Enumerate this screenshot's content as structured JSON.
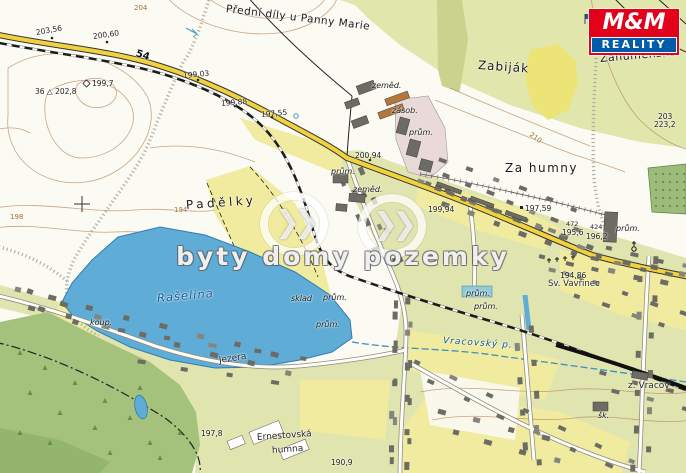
{
  "map_title": "Topographic cadastral map – Vracov area",
  "watermark": {
    "text": "byty domy pozemky",
    "chevrons": "❯❯"
  },
  "logo": {
    "top": "M&M",
    "bottom": "REALITY",
    "red": "#e2001a",
    "blue": "#005ca9"
  },
  "road_badge": {
    "t": "54",
    "x": 136,
    "y": 48,
    "r": 18
  },
  "colors": {
    "lake": "#5facd7",
    "road": "#f1d23e",
    "forest": "#a5c27c",
    "village_green": "#e0e5af",
    "field_yellow": "#f1eba0",
    "contour_brown": "#b5895e",
    "building_gray": "#6c6c64",
    "railway_black": "#1b1b1b",
    "industrial_pink": "#e9d9d8",
    "water_label_blue": "#14568f"
  },
  "labels": {
    "places": [
      {
        "t": "Přední díly u Panny Marie",
        "x": 226,
        "y": 3,
        "r": 7,
        "s": 10.5,
        "ls": 0.5
      },
      {
        "t": "Zabiják",
        "x": 478,
        "y": 58,
        "r": 4,
        "s": 12,
        "ls": 1
      },
      {
        "t": "Záhumenské",
        "x": 600,
        "y": 52,
        "r": -5,
        "s": 11,
        "ls": 0.5
      },
      {
        "t": "Za humny",
        "x": 505,
        "y": 161,
        "r": 0,
        "s": 12,
        "ls": 1.5
      },
      {
        "t": "Padělky",
        "x": 186,
        "y": 198,
        "r": -4,
        "s": 12,
        "ls": 3.5
      }
    ],
    "places_small": [
      {
        "t": "Ernestovská",
        "x": 257,
        "y": 433,
        "r": -4
      },
      {
        "t": "humna",
        "x": 272,
        "y": 446,
        "r": -4
      },
      {
        "t": "Jezera",
        "x": 219,
        "y": 356,
        "r": -9
      },
      {
        "t": "z. Vracov",
        "x": 628,
        "y": 381,
        "r": 0
      },
      {
        "t": "Sv. Vavřinec",
        "x": 548,
        "y": 279,
        "r": 0,
        "s": 8.5
      }
    ],
    "water": [
      {
        "t": "Rašelina",
        "x": 157,
        "y": 291,
        "r": -5,
        "s": 11.5
      },
      {
        "t": "Vracovský p.",
        "x": 443,
        "y": 336,
        "r": 4,
        "s": 9
      }
    ],
    "elevations": [
      {
        "t": "203,56",
        "x": 36,
        "y": 28,
        "r": -10
      },
      {
        "t": "200,60",
        "x": 93,
        "y": 32,
        "r": -8
      },
      {
        "t": "199,7",
        "x": 92,
        "y": 79
      },
      {
        "t": "36 △ 202,8",
        "x": 35,
        "y": 87
      },
      {
        "t": "199,03",
        "x": 183,
        "y": 71,
        "r": -5
      },
      {
        "t": "199,88",
        "x": 221,
        "y": 99,
        "r": -5
      },
      {
        "t": "197,55",
        "x": 261,
        "y": 110,
        "r": -5
      },
      {
        "t": "200,94",
        "x": 355,
        "y": 151
      },
      {
        "t": "199,94",
        "x": 428,
        "y": 205
      },
      {
        "t": "197,59",
        "x": 525,
        "y": 204
      },
      {
        "t": "472",
        "x": 566,
        "y": 220,
        "s": 6.5
      },
      {
        "t": "195,6",
        "x": 562,
        "y": 228
      },
      {
        "t": "424",
        "x": 590,
        "y": 223,
        "s": 6.5
      },
      {
        "t": "196,2",
        "x": 586,
        "y": 232
      },
      {
        "t": "194,86",
        "x": 560,
        "y": 271
      },
      {
        "t": "197,8",
        "x": 201,
        "y": 429
      },
      {
        "t": "190,9",
        "x": 331,
        "y": 458
      },
      {
        "t": "203",
        "x": 658,
        "y": 112
      },
      {
        "t": "223,2",
        "x": 654,
        "y": 120
      }
    ],
    "contour_labels": [
      {
        "t": "198",
        "x": 10,
        "y": 213
      },
      {
        "t": "194",
        "x": 174,
        "y": 206
      },
      {
        "t": "210",
        "x": 530,
        "y": 130,
        "r": 35
      },
      {
        "t": "204",
        "x": 134,
        "y": 4
      }
    ],
    "abbrev": [
      {
        "t": "zeměd.",
        "x": 372,
        "y": 81
      },
      {
        "t": "zásob.",
        "x": 392,
        "y": 106
      },
      {
        "t": "prům.",
        "x": 409,
        "y": 128
      },
      {
        "t": "prům.",
        "x": 331,
        "y": 167
      },
      {
        "t": "zeměd.",
        "x": 353,
        "y": 185
      },
      {
        "t": "prům.",
        "x": 616,
        "y": 224
      },
      {
        "t": "sklad",
        "x": 291,
        "y": 294
      },
      {
        "t": "prům.",
        "x": 323,
        "y": 293
      },
      {
        "t": "prům.",
        "x": 466,
        "y": 289
      },
      {
        "t": "prům.",
        "x": 474,
        "y": 302
      },
      {
        "t": "prům.",
        "x": 316,
        "y": 320
      },
      {
        "t": "koup.",
        "x": 90,
        "y": 318
      },
      {
        "t": "šk.",
        "x": 598,
        "y": 411
      }
    ]
  }
}
